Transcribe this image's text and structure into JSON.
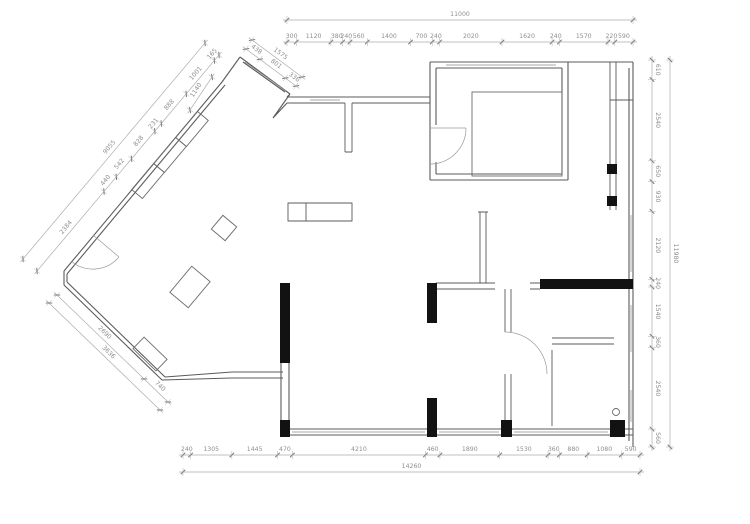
{
  "dimensions": {
    "top": {
      "overall": "11000",
      "segments": [
        "300",
        "1120",
        "380",
        "240",
        "560",
        "1400",
        "700",
        "240",
        "2020",
        "1620",
        "240",
        "1570",
        "220",
        "590"
      ]
    },
    "right": {
      "overall": "11980",
      "segments": [
        "610",
        "2540",
        "650",
        "930",
        "2120",
        "240",
        "1540",
        "360",
        "2540",
        "560"
      ]
    },
    "bottom": {
      "overall": "14260",
      "segments": [
        "240",
        "1305",
        "1445",
        "470",
        "4210",
        "460",
        "1890",
        "1530",
        "360",
        "880",
        "1080",
        "590"
      ]
    },
    "diag_upper": {
      "overall": "9055",
      "segments": [
        "165",
        "1001",
        "888",
        "231",
        "828",
        "542",
        "440",
        "2384"
      ]
    },
    "diag_lower": {
      "overall": "3636",
      "segments": [
        "2690",
        "740"
      ]
    },
    "bay": {
      "overall": "1575",
      "segments": [
        "438",
        "801",
        "336"
      ],
      "side": "1140"
    }
  },
  "colors": {
    "wall": "#5b5b5b",
    "poche": "#121212",
    "dim_line": "#ababab",
    "dim_tick": "#7a7a7a",
    "dim_text": "#8f8f8f",
    "background": "#ffffff"
  }
}
